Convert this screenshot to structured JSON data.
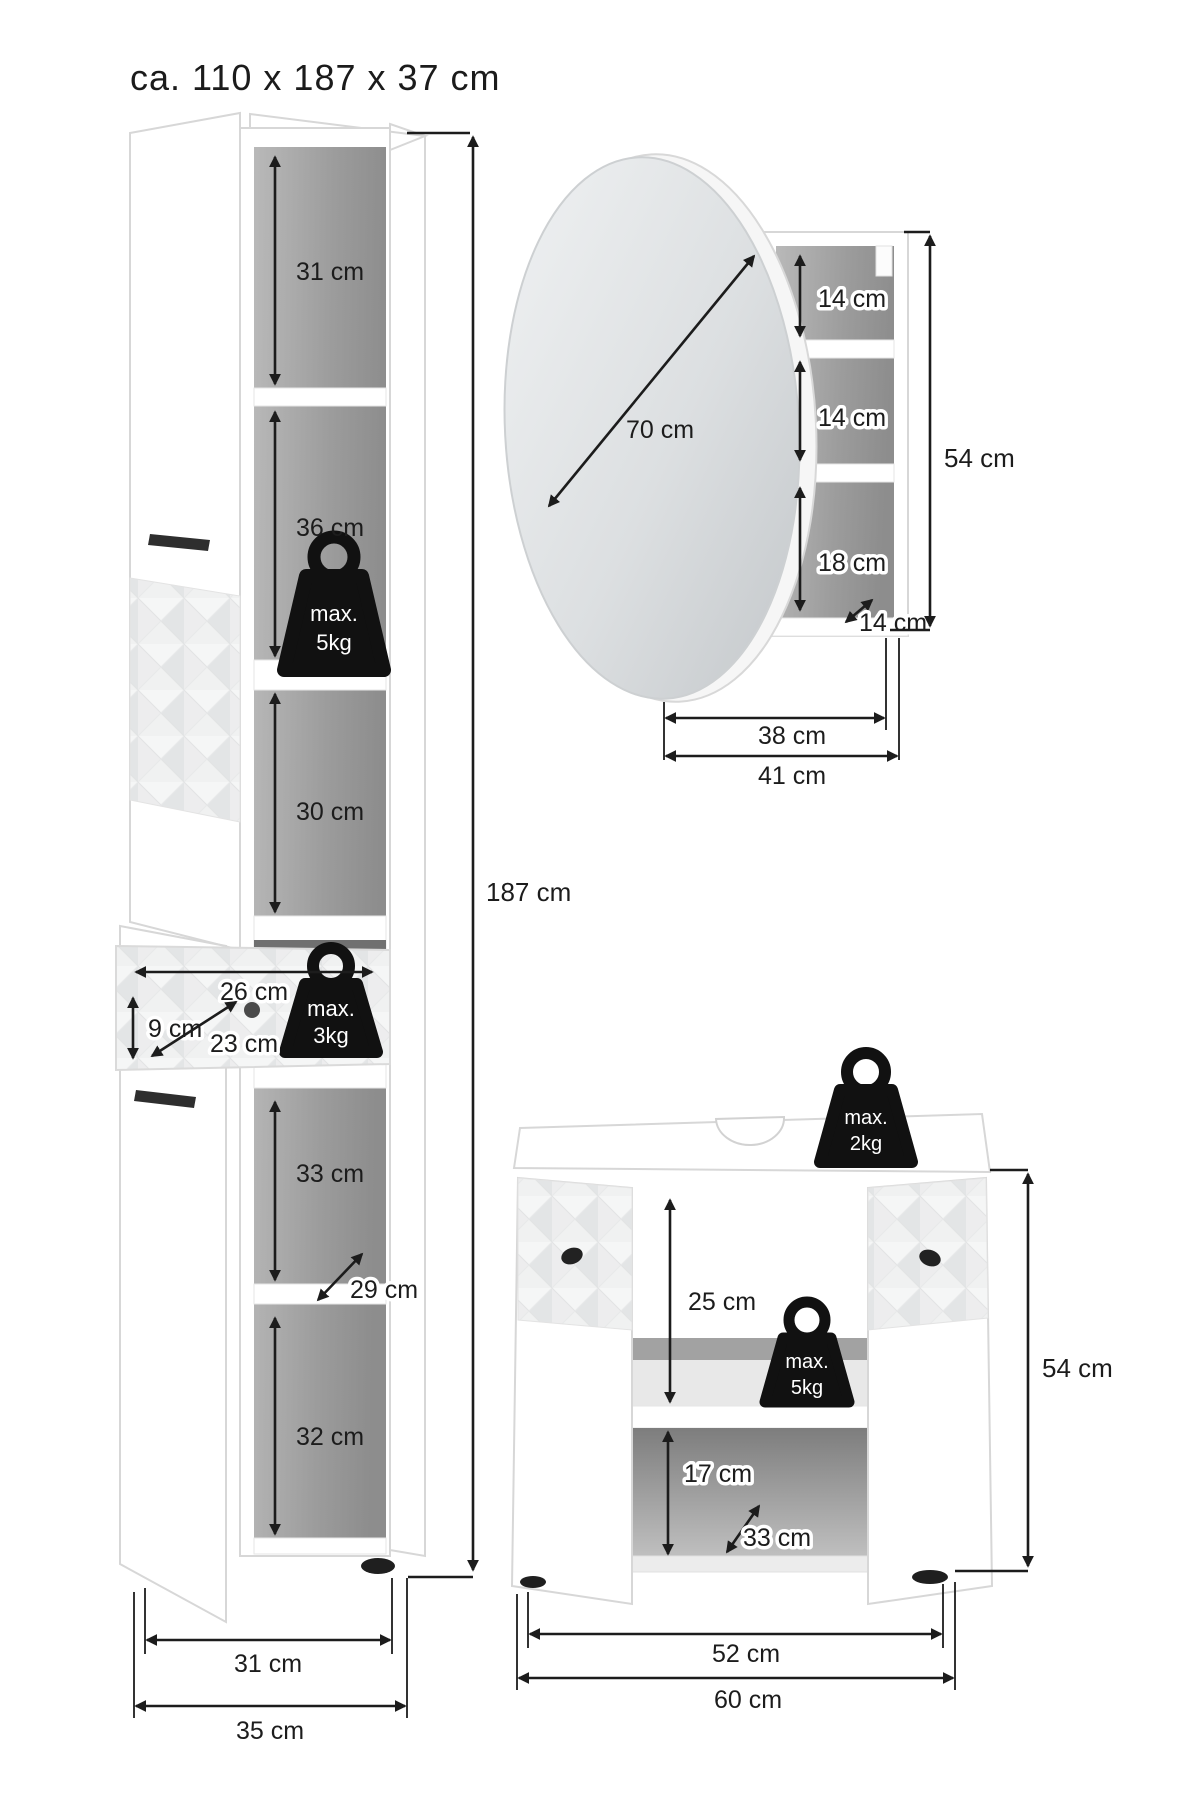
{
  "title": "ca. 110 x 187 x 37 cm",
  "tall_cabinet": {
    "compartment_top": "31 cm",
    "compartment_2": "36 cm",
    "compartment_3": "30 cm",
    "drawer_width": "26 cm",
    "drawer_height": "9 cm",
    "drawer_depth": "23 cm",
    "compartment_4": "33 cm",
    "shelf_depth": "29 cm",
    "compartment_5": "32 cm",
    "total_height": "187 cm",
    "inner_width": "31 cm",
    "total_width": "35 cm",
    "max_load_shelf": {
      "line1": "max.",
      "line2": "5kg"
    },
    "max_load_drawer": {
      "line1": "max.",
      "line2": "3kg"
    }
  },
  "mirror_cabinet": {
    "mirror_diameter": "70 cm",
    "compartment_top": "14 cm",
    "compartment_middle": "14 cm",
    "compartment_bottom": "18 cm",
    "shelf_depth": "14 cm",
    "total_height": "54 cm",
    "shelf_width": "38 cm",
    "total_width": "41 cm"
  },
  "vanity": {
    "max_load_top": {
      "line1": "max.",
      "line2": "2kg"
    },
    "max_load_shelf": {
      "line1": "max.",
      "line2": "5kg"
    },
    "opening_height": "25 cm",
    "compartment_height": "17 cm",
    "shelf_depth": "33 cm",
    "total_height": "54 cm",
    "inner_width": "52 cm",
    "total_width": "60 cm"
  }
}
